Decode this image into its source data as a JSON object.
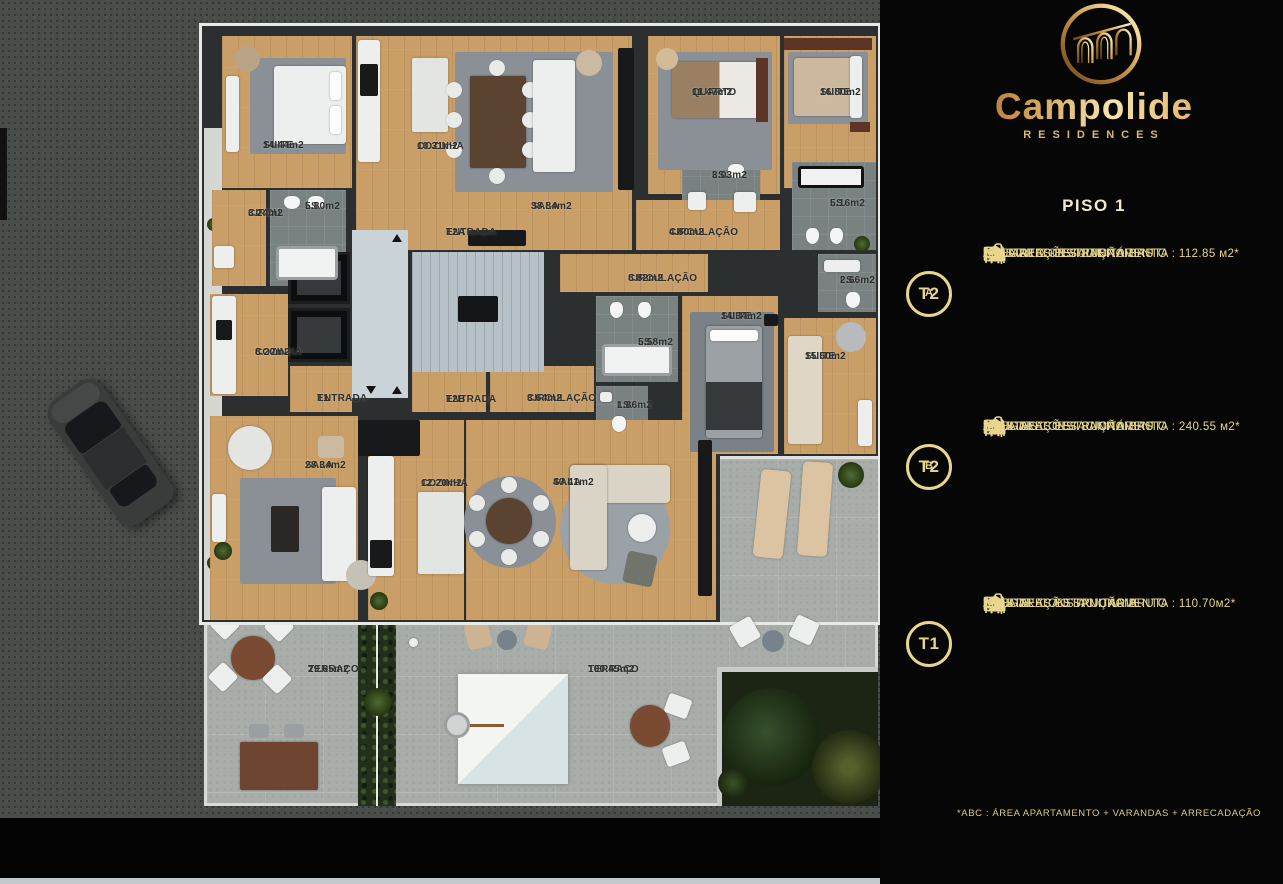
{
  "brand": {
    "name": "Campolide",
    "tagline": "RESIDENCES",
    "floor_title": "PISO 1",
    "footnote": "*ABC :  ÁREA APARTAMENTO + VARANDAS + ARRECADAÇÃO"
  },
  "colors": {
    "gold": "#e7d68c",
    "gold_gradient_dark": "#7c4d1d",
    "gold_gradient_light": "#f6e5ad",
    "panel_bg": "#060606",
    "wood_floor": "#c99e67",
    "terrace_concrete": "#a8ada9",
    "asphalt": "#494d4a",
    "wall": "#2c2f30"
  },
  "units": [
    {
      "badge": "T2",
      "badge_sub": "A",
      "specs": [
        {
          "icon": "floorplan-icon",
          "text": "ÁREA DE CONSTRUÇÃO BRUTA :  112.85 м2*"
        },
        {
          "icon": "bed-icon",
          "text": "1 QUARTO + 1 SUITE"
        },
        {
          "icon": "shower-icon",
          "text": "2 INSTALAÇÕES SANITÁRIAS"
        },
        {
          "icon": "garage-icon",
          "text": "2 LUGARES ESTACIONAMENTO"
        }
      ]
    },
    {
      "badge": "T2",
      "badge_sub": "B",
      "specs": [
        {
          "icon": "floorplan-icon",
          "text": "ÁREA DE CONSTRUÇÃO BRUTA :  240.55 м2*"
        },
        {
          "icon": "bed-icon",
          "text": "2 SUITES"
        },
        {
          "icon": "shower-icon",
          "text": "3 INSTALAÇÕES SANITÁRIAS"
        },
        {
          "icon": "garage-icon",
          "text": "2 LUGARES ESTACIONAMENTO"
        }
      ]
    },
    {
      "badge": "T1",
      "badge_sub": "",
      "specs": [
        {
          "icon": "floorplan-icon",
          "text": "ÁREA DE CONSTRUÇÃO BRUTA :  110.70м2*"
        },
        {
          "icon": "bed-icon",
          "text": "1 SUITE"
        },
        {
          "icon": "shower-icon",
          "text": "1 INSTALAÇÃO SANITÁRIA"
        },
        {
          "icon": "garage-icon",
          "text": "2 LUGARES ESTACIONAMENTO"
        }
      ]
    }
  ],
  "floorplan": {
    "labels": [
      {
        "name": "SUITE",
        "area": "14.44m2",
        "x": 263,
        "y": 140
      },
      {
        "name": "COZINHA",
        "area": "10.31m2",
        "x": 417,
        "y": 141
      },
      {
        "name": "SALA",
        "area": "38.84m2",
        "x": 531,
        "y": 201
      },
      {
        "name": "QUARTO",
        "area": "11.47m2",
        "x": 692,
        "y": 87
      },
      {
        "name": "SUITE",
        "area": "16.80m2",
        "x": 820,
        "y": 87
      },
      {
        "name": "I.S.",
        "area": "3.03m2",
        "x": 712,
        "y": 170
      },
      {
        "name": "I.S.",
        "area": "5.16m2",
        "x": 830,
        "y": 198
      },
      {
        "name": "CIRCU.",
        "area": "3.24m2",
        "x": 248,
        "y": 208
      },
      {
        "name": "I.S.",
        "area": "5.80m2",
        "x": 305,
        "y": 201
      },
      {
        "name": "ENTRADA",
        "area": "T2A",
        "x": 446,
        "y": 227
      },
      {
        "name": "CIRCULAÇÃO",
        "area": "4.80m2",
        "x": 669,
        "y": 227
      },
      {
        "name": "CIRCULAÇÃO",
        "area": "8.82m2",
        "x": 628,
        "y": 273
      },
      {
        "name": "I.S.",
        "area": "2.66m2",
        "x": 840,
        "y": 275
      },
      {
        "name": "SUITE",
        "area": "14.34m2",
        "x": 721,
        "y": 311
      },
      {
        "name": "I.S.",
        "area": "5.58m2",
        "x": 638,
        "y": 337
      },
      {
        "name": "SUITE",
        "area": "15.60m2",
        "x": 805,
        "y": 351
      },
      {
        "name": "COZINHA",
        "area": "8.20m2",
        "x": 255,
        "y": 347
      },
      {
        "name": "ENTRADA",
        "area": "T1",
        "x": 317,
        "y": 393
      },
      {
        "name": "ENTRADA",
        "area": "T2B",
        "x": 446,
        "y": 394
      },
      {
        "name": "CIRCULAÇÃO",
        "area": "3.64m2",
        "x": 527,
        "y": 393
      },
      {
        "name": "I.S.",
        "area": "1.86m2",
        "x": 617,
        "y": 400
      },
      {
        "name": "SALA",
        "area": "28.34m2",
        "x": 305,
        "y": 460
      },
      {
        "name": "COZINHA",
        "area": "12.20m2",
        "x": 421,
        "y": 478
      },
      {
        "name": "SALA",
        "area": "40.41m2",
        "x": 553,
        "y": 477
      },
      {
        "name": "TERRAÇO",
        "area": "29.65m2",
        "x": 308,
        "y": 664
      },
      {
        "name": "TERRAÇO",
        "area": "100.45m2",
        "x": 588,
        "y": 664
      }
    ]
  }
}
